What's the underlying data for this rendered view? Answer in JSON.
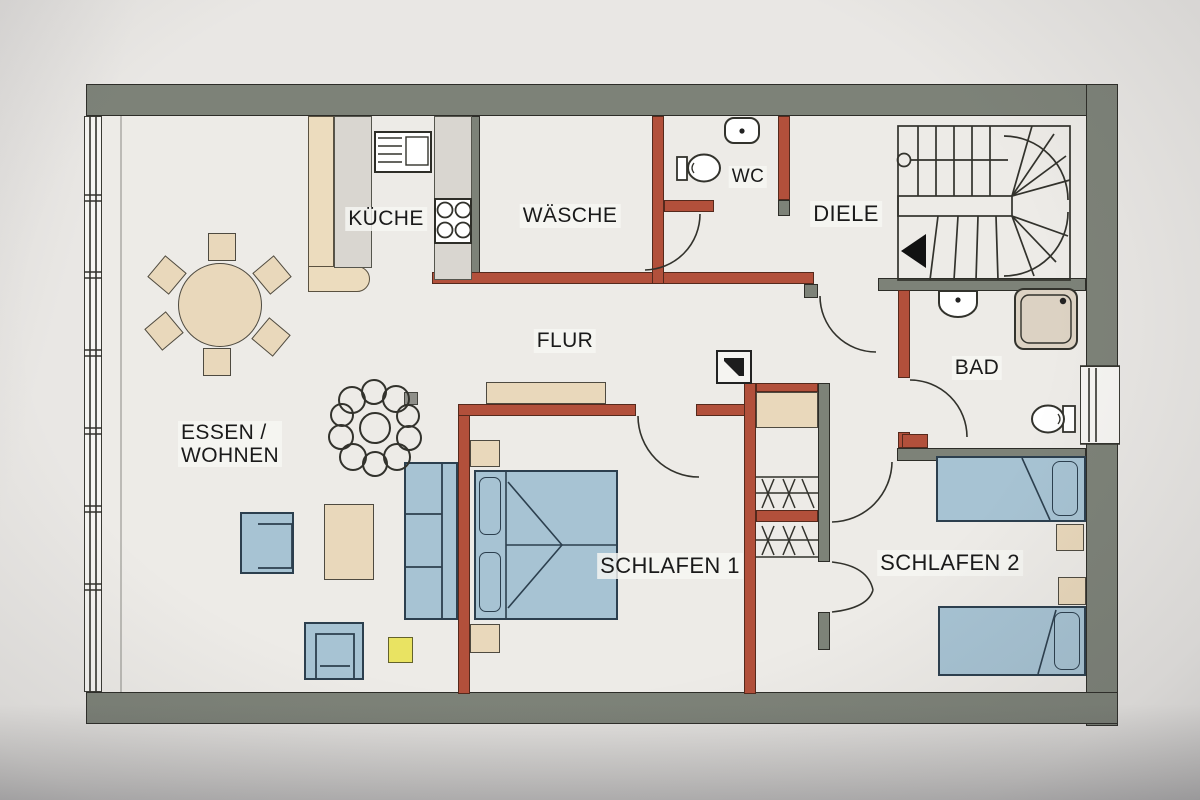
{
  "document": {
    "kind": "floor-plan-photo",
    "language": "de"
  },
  "rooms": {
    "kueche": "KÜCHE",
    "waesche": "WÄSCHE",
    "wc": "WC",
    "diele": "DIELE",
    "bad": "BAD",
    "flur": "FLUR",
    "essen_wohnen_line1": "ESSEN /",
    "essen_wohnen_line2": "WOHNEN",
    "schlafen1": "SCHLAFEN 1",
    "schlafen2": "SCHLAFEN 2"
  },
  "palette": {
    "paper": "#e9e7e4",
    "floor": "#edebe7",
    "wall_exterior": "#7d8278",
    "wall_interior": "#b2503b",
    "wall_partition_beige": "#ecdcbe",
    "counter_gray": "#d9d6d0",
    "furniture_beige": "#e9d8bb",
    "furniture_blue": "#a7c3d3",
    "stool_yellow": "#e9e362",
    "shower_tray": "#dcd2c3",
    "window_white": "#f6f5f2"
  },
  "icons": {
    "chimney": "chimney-square-symbol",
    "stair_arrow": "arrow-left",
    "plant": "scribbled-plant",
    "wardrobe": "clothes-rail-with-hangers",
    "stairs": "u-shaped-winder-staircase"
  }
}
